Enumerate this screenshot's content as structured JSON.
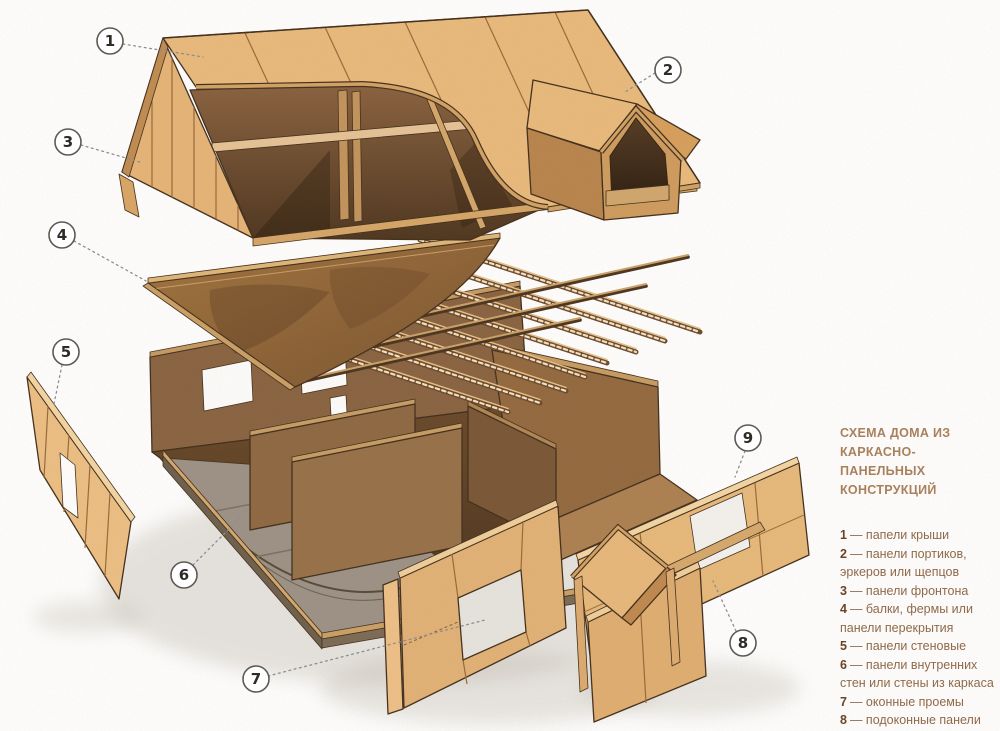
{
  "legend": {
    "title_line1": "СХЕМА ДОМА ИЗ КАРКАСНО-",
    "title_line2": "ПАНЕЛЬНЫХ КОНСТРУКЦИЙ",
    "items": [
      {
        "num": "1",
        "text": "— папели крыши"
      },
      {
        "num": "2",
        "text": "— панели портиков, эркеров или щепцов"
      },
      {
        "num": "3",
        "text": "— панели фронтона"
      },
      {
        "num": "4",
        "text": "— балки, фермы или панели перекрытия"
      },
      {
        "num": "5",
        "text": "— панели стеновые"
      },
      {
        "num": "6",
        "text": "— панели внутренних стен или стены из каркаса"
      },
      {
        "num": "7",
        "text": "— оконные проемы"
      },
      {
        "num": "8",
        "text": "— подоконные панели"
      },
      {
        "num": "9",
        "text": "— панели перемычек"
      }
    ]
  },
  "callouts": [
    {
      "label": "1"
    },
    {
      "label": "2"
    },
    {
      "label": "3"
    },
    {
      "label": "4"
    },
    {
      "label": "5"
    },
    {
      "label": "6"
    },
    {
      "label": "7"
    },
    {
      "label": "8"
    },
    {
      "label": "9"
    }
  ],
  "colors": {
    "panel_light": "#e9ba7d",
    "panel_mid": "#d5a263",
    "wood_dark": "#6a4a2c",
    "outline": "#43301d",
    "legend_title": "#a9805c",
    "legend_text": "#8f6a4a",
    "legend_number": "#6b4426",
    "background": "#ffffff"
  }
}
